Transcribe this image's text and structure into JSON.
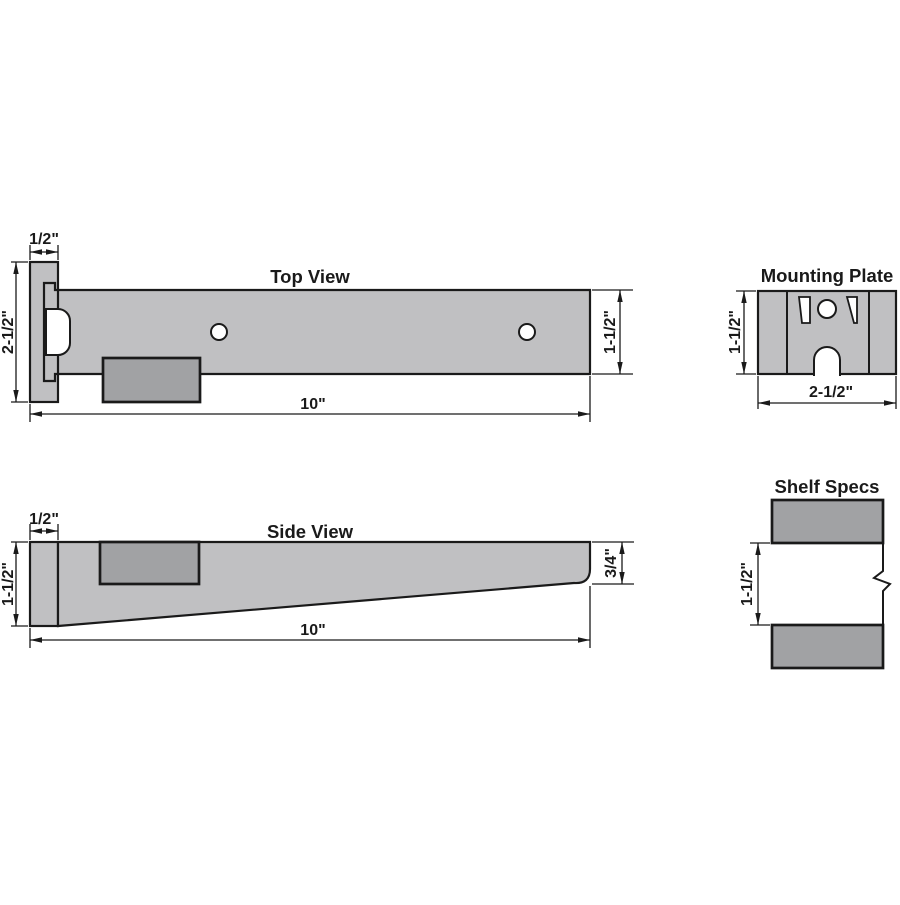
{
  "drawing": {
    "colors": {
      "part": "#c0c0c2",
      "block": "#a1a2a4",
      "outline": "#1a1a1a",
      "background": "#ffffff"
    },
    "top_view": {
      "title": "Top View",
      "dims": {
        "plate_width": "1/2\"",
        "overall_depth": "2-1/2\"",
        "arm_depth": "1-1/2\"",
        "length": "10\""
      }
    },
    "side_view": {
      "title": "Side View",
      "dims": {
        "plate_width": "1/2\"",
        "height": "1-1/2\"",
        "tip_height": "3/4\"",
        "length": "10\""
      }
    },
    "mounting_plate": {
      "title": "Mounting Plate",
      "dims": {
        "height": "1-1/2\"",
        "width": "2-1/2\""
      }
    },
    "shelf_specs": {
      "title": "Shelf Specs",
      "dims": {
        "slot_height": "1-1/2\""
      }
    }
  }
}
